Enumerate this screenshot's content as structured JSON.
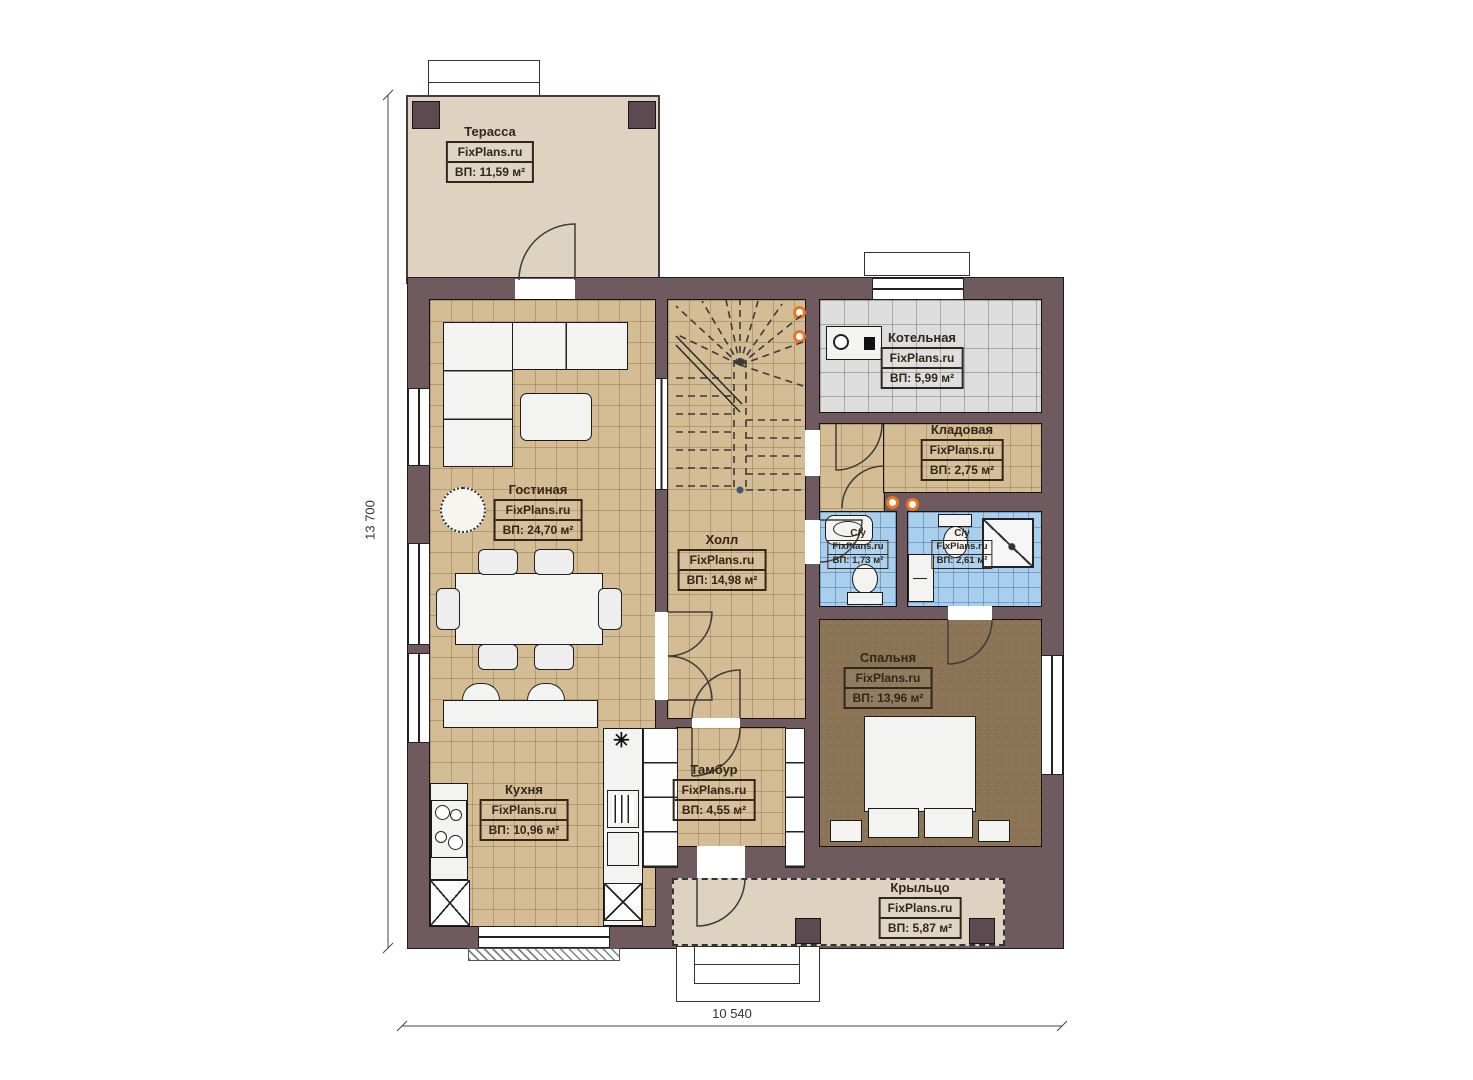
{
  "plan": {
    "watermark": "FixPlans.ru",
    "symbols": {
      "cooktop": "✳"
    },
    "dimensions": {
      "height": "13 700",
      "width": "10 540"
    },
    "colors": {
      "wall": "#6e5a5f",
      "floor_tan": "#d4bc94",
      "floor_gray": "#dcdddc",
      "floor_blue": "#a9cfec",
      "floor_brown": "#8b7355",
      "floor_beige": "#ded3c1",
      "accent_orange": "#e87722",
      "label_text": "#33261a"
    },
    "rooms": [
      {
        "id": "terrace",
        "name": "Терасса",
        "area": "ВП: 11,59 м²"
      },
      {
        "id": "boiler",
        "name": "Котельная",
        "area": "ВП: 5,99 м²"
      },
      {
        "id": "storage",
        "name": "Кладовая",
        "area": "ВП: 2,75 м²"
      },
      {
        "id": "living",
        "name": "Гостиная",
        "area": "ВП: 24,70 м²"
      },
      {
        "id": "hall",
        "name": "Холл",
        "area": "ВП: 14,98 м²"
      },
      {
        "id": "bath1",
        "name": "С/у",
        "area": "ВП: 1,73 м²"
      },
      {
        "id": "bath2",
        "name": "С/у",
        "area": "ВП: 2,61 м²"
      },
      {
        "id": "bedroom",
        "name": "Спальня",
        "area": "ВП: 13,96 м²"
      },
      {
        "id": "vestibule",
        "name": "Тамбур",
        "area": "ВП: 4,55 м²"
      },
      {
        "id": "kitchen",
        "name": "Кухня",
        "area": "ВП: 10,96 м²"
      },
      {
        "id": "porch",
        "name": "Крыльцо",
        "area": "ВП: 5,87 м²"
      }
    ]
  }
}
